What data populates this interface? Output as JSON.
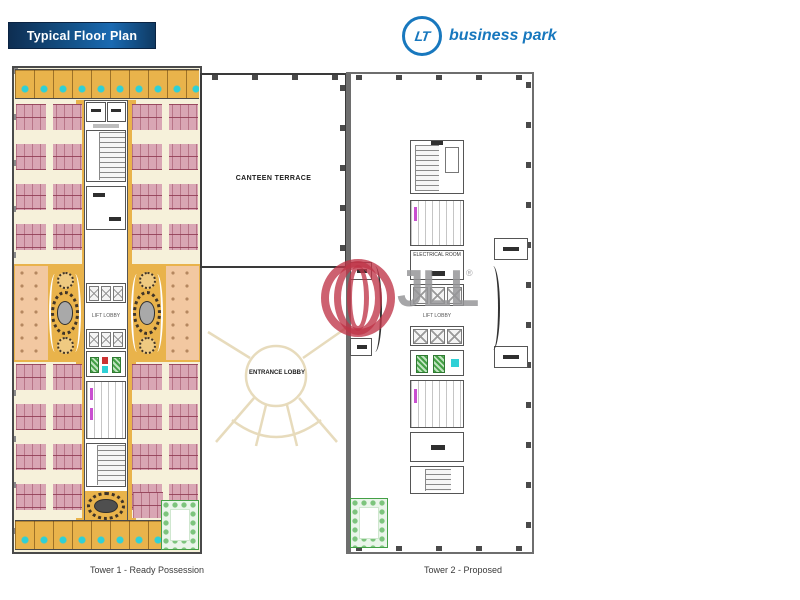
{
  "header": {
    "banner_label": "Typical Floor Plan",
    "logo": {
      "monogram": "LT",
      "name": "business park"
    }
  },
  "watermark": {
    "text": "JLL",
    "registered": "®"
  },
  "floorplan": {
    "canteen_label": "CANTEEN TERRACE",
    "entrance_label": "ENTRANCE LOBBY",
    "tower1": {
      "lift_lobby_label": "LIFT LOBBY",
      "caption": "Tower 1 - Ready Possession"
    },
    "tower2": {
      "lift_lobby_label": "LIFT LOBBY",
      "electrical_label": "ELECTRICAL ROOM",
      "caption": "Tower 2 - Proposed"
    }
  },
  "colors": {
    "banner_navy": "#0d2b4d",
    "banner_blue": "#1669ad",
    "logo_blue": "#1878be",
    "plan_cream": "#f6f1da",
    "cabin_orange": "#e9b34b",
    "workstation_pink": "#d9a6b4",
    "salmon": "#f2c8a1",
    "chair_cyan": "#2fd0d6",
    "garden_green": "#44a046",
    "toilet_magenta": "#c94fd0",
    "wall_gray": "#4a4a4a",
    "watermark_red": "#bf3548",
    "watermark_gray": "#96969a"
  }
}
